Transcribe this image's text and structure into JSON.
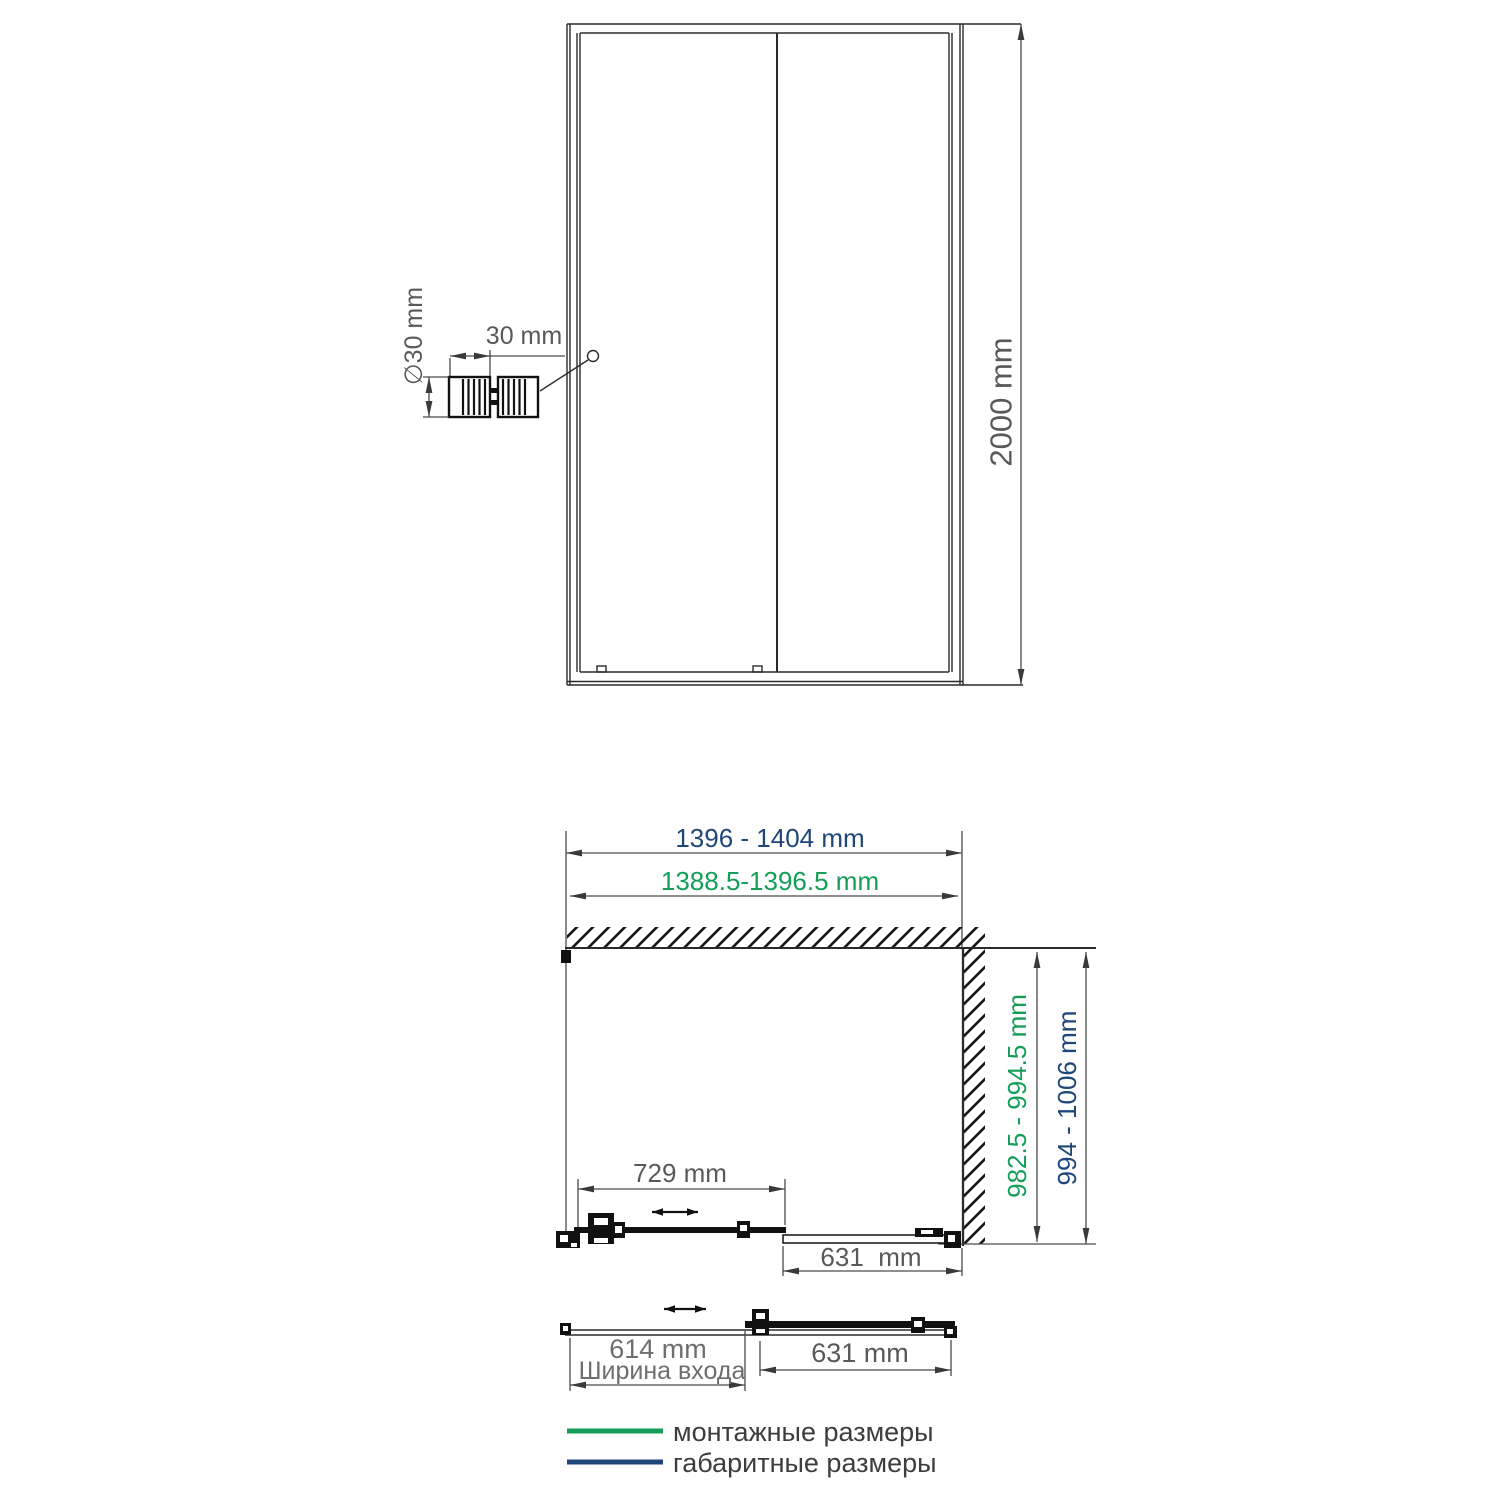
{
  "drawing": {
    "front_view": {
      "height_label": "2000 mm",
      "handle_diameter_label": "∅30 mm",
      "handle_width_label": "30 mm"
    },
    "plan_view": {
      "overall_width_label": "1396 - 1404 mm",
      "install_width_label": "1388.5-1396.5 mm",
      "install_depth_label": "982.5 - 994.5 mm",
      "overall_depth_label": "994 - 1006 mm",
      "sliding_panel_label": "729 mm",
      "fixed_panel_label": "631  mm"
    },
    "open_view": {
      "entry_width_label": "614 mm",
      "entry_width_caption": "Ширина входа",
      "fixed_panel_label": "631 mm"
    },
    "legend": {
      "install_label": "монтажные размеры",
      "overall_label": "габаритные размеры"
    },
    "colors": {
      "install_green": "#149e57",
      "overall_navy": "#1f4679",
      "dim_text_gray": "#595959",
      "line_black": "#2b2b2b"
    }
  }
}
